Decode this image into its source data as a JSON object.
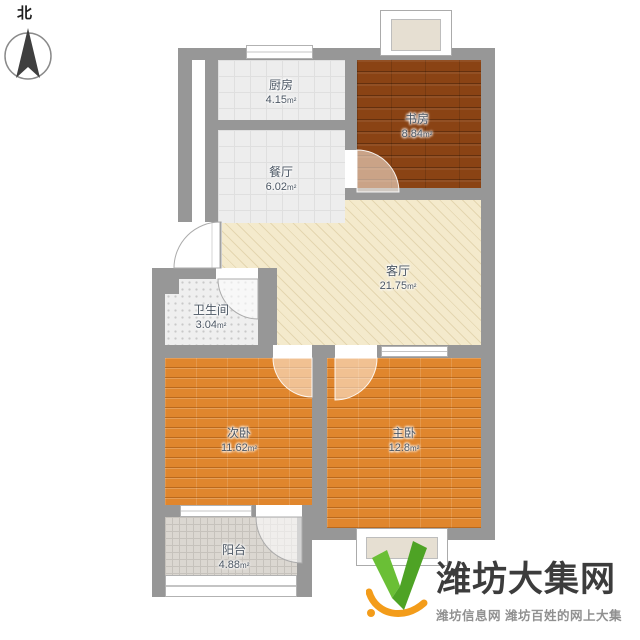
{
  "compass": {
    "label": "北"
  },
  "rooms": [
    {
      "name": "厨房",
      "area": "4.15",
      "unit": "m²"
    },
    {
      "name": "餐厅",
      "area": "6.02",
      "unit": "m²"
    },
    {
      "name": "书房",
      "area": "8.84",
      "unit": "m²"
    },
    {
      "name": "客厅",
      "area": "21.75",
      "unit": "m²"
    },
    {
      "name": "卫生间",
      "area": "3.04",
      "unit": "m²"
    },
    {
      "name": "次卧",
      "area": "11.62",
      "unit": "m²"
    },
    {
      "name": "主卧",
      "area": "12.8",
      "unit": "m²"
    },
    {
      "name": "阳台",
      "area": "4.88",
      "unit": "m²"
    }
  ],
  "watermark": {
    "site_name": "潍坊大集网",
    "tagline": "潍坊信息网 潍坊百姓的网上大集"
  },
  "colors": {
    "wall": "#979797",
    "study_wood": "#8a4314",
    "bedroom_wood": "#e0862d",
    "living_cream": "#f4eacc",
    "logo_green": "#5fb32c",
    "logo_orange": "#f39c1a"
  }
}
